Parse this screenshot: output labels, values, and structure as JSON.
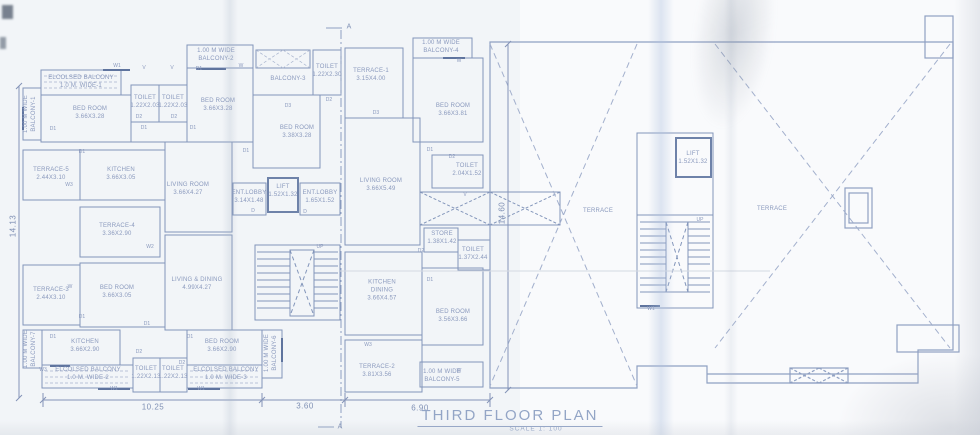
{
  "title": {
    "text": "THIRD FLOOR PLAN",
    "scale": "SCALE 1: 100"
  },
  "dims": {
    "height_left": "14.13",
    "width_1": "10.25",
    "width_2": "3.60",
    "width_3": "6.90",
    "height_mid": "14.60"
  },
  "section": {
    "top": "A",
    "bottom": "A"
  },
  "colors": {
    "ink": "#8295ba",
    "text": "#8a99bd",
    "paper": "#f9fafc",
    "dark_marks": "#5f749e"
  },
  "rooms": [
    {
      "l1": "ELCOLSED BALCONY",
      "l2": "1.0 M. WIDE-1"
    },
    {
      "l1": "BED ROOM",
      "l2": "3.66X3.28"
    },
    {
      "l1": "TOILET",
      "l2": "1.22X2.03"
    },
    {
      "l1": "TOILET",
      "l2": "1.22X2.03"
    },
    {
      "l1": "BED ROOM",
      "l2": "3.66X3.28"
    },
    {
      "l1": "1.00 M WIDE",
      "l2": "BALCONY-2"
    },
    {
      "l1": "BALCONY-3",
      "l2": ""
    },
    {
      "l1": "TOILET",
      "l2": "1.22X2.30"
    },
    {
      "l1": "BED ROOM",
      "l2": "3.38X3.28"
    },
    {
      "l1": "1.00 M WIDE",
      "l2": "BALCONY-1"
    },
    {
      "l1": "TERRACE-5",
      "l2": "2.44X3.10"
    },
    {
      "l1": "KITCHEN",
      "l2": "3.66X3.05"
    },
    {
      "l1": "LIVING ROOM",
      "l2": "3.66X4.27"
    },
    {
      "l1": "TERRACE-4",
      "l2": "3.36X2.90"
    },
    {
      "l1": "TERRACE-3",
      "l2": "2.44X3.10"
    },
    {
      "l1": "BED ROOM",
      "l2": "3.66X3.05"
    },
    {
      "l1": "LIVING & DINING",
      "l2": "4.99X4.27"
    },
    {
      "l1": "ENT.LOBBY",
      "l2": "3.14X1.48"
    },
    {
      "l1": "LIFT",
      "l2": "1.52X1.32"
    },
    {
      "l1": "ENT.LOBBY",
      "l2": "1.65X1.52"
    },
    {
      "l1": "KITCHEN",
      "l2": "3.66X2.90"
    },
    {
      "l1": "ELCOLSED BALCONY",
      "l2": "1.0 M. WIDE-2"
    },
    {
      "l1": "TOILET",
      "l2": "1.22X2.13"
    },
    {
      "l1": "TOILET",
      "l2": "1.22X2.13"
    },
    {
      "l1": "BED ROOM",
      "l2": "3.66X2.90"
    },
    {
      "l1": "ELCOLSED BALCONY",
      "l2": "1.0 M. WIDE-3"
    },
    {
      "l1": "1.00 M WIDE",
      "l2": "BALCONY-7"
    },
    {
      "l1": "1.00 M WIDE",
      "l2": "BALCONY-6"
    },
    {
      "l1": "TERRACE-1",
      "l2": "3.15X4.00"
    },
    {
      "l1": "1.00 M WIDE",
      "l2": "BALCONY-4"
    },
    {
      "l1": "BED ROOM",
      "l2": "3.66X3.81"
    },
    {
      "l1": "LIVING ROOM",
      "l2": "3.66X5.49"
    },
    {
      "l1": "TOILET",
      "l2": "2.04X1.52"
    },
    {
      "l1": "STORE",
      "l2": "1.38X1.42"
    },
    {
      "l1": "TOILET",
      "l2": "1.37X2.44"
    },
    {
      "l1": "KITCHEN DINING",
      "l2": "3.66X4.57"
    },
    {
      "l1": "BED ROOM",
      "l2": "3.56X3.66"
    },
    {
      "l1": "TERRACE-2",
      "l2": "3.81X3.56"
    },
    {
      "l1": "1.00 M WIDE",
      "l2": "BALCONY-5"
    },
    {
      "l1": "TERRACE",
      "l2": ""
    },
    {
      "l1": "LIFT",
      "l2": "1.52X1.32"
    },
    {
      "l1": "TERRACE",
      "l2": ""
    }
  ],
  "tags": [
    "W1",
    "V",
    "V",
    "D1",
    "W",
    "D1",
    "D2",
    "D2",
    "D1",
    "D1",
    "D3",
    "D2",
    "D1",
    "W3",
    "D1",
    "W2",
    "W",
    "D1",
    "D1",
    "D1",
    "D1",
    "W3",
    "D2",
    "D2",
    "W1",
    "W1",
    "UP",
    "D3",
    "D1",
    "D2",
    "W",
    "D2",
    "D1",
    "W3",
    "W",
    "UP",
    "W1",
    "V",
    "D",
    "D"
  ]
}
